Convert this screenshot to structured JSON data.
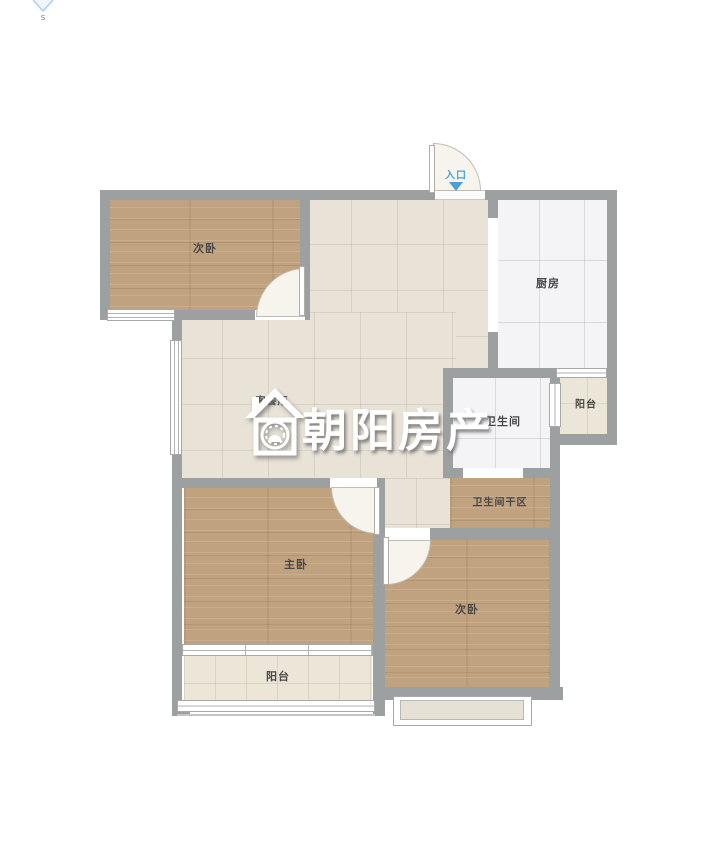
{
  "compass": {
    "south_label": "s"
  },
  "entrance": {
    "label": "入口"
  },
  "watermark": {
    "brand": "朝阳房产"
  },
  "rooms": {
    "bedroom_top_left": {
      "label": "次卧",
      "floor": "wood"
    },
    "kitchen": {
      "label": "厨房",
      "floor": "white-tile"
    },
    "balcony_right": {
      "label": "阳台",
      "floor": "cream-tile"
    },
    "bathroom": {
      "label": "卫生间",
      "floor": "white-tile"
    },
    "bathroom_dry_area": {
      "label": "卫生间干区",
      "floor": "wood"
    },
    "living_dining": {
      "label": "客餐厅",
      "floor": "beige-tile"
    },
    "master_bedroom": {
      "label": "主卧",
      "floor": "wood"
    },
    "bedroom_bottom_right": {
      "label": "次卧",
      "floor": "wood"
    },
    "balcony_bottom": {
      "label": "阳台",
      "floor": "cream-tile"
    }
  },
  "colors": {
    "wall": "#9da0a1",
    "wood_floor": "#c1a27e",
    "beige_tile": "#e8e2d7",
    "white_tile": "#f4f4f6",
    "cream_tile": "#ece6d8",
    "entrance_blue": "#4d9fd6",
    "label_text": "#474747",
    "watermark_white": "#ffffff"
  }
}
